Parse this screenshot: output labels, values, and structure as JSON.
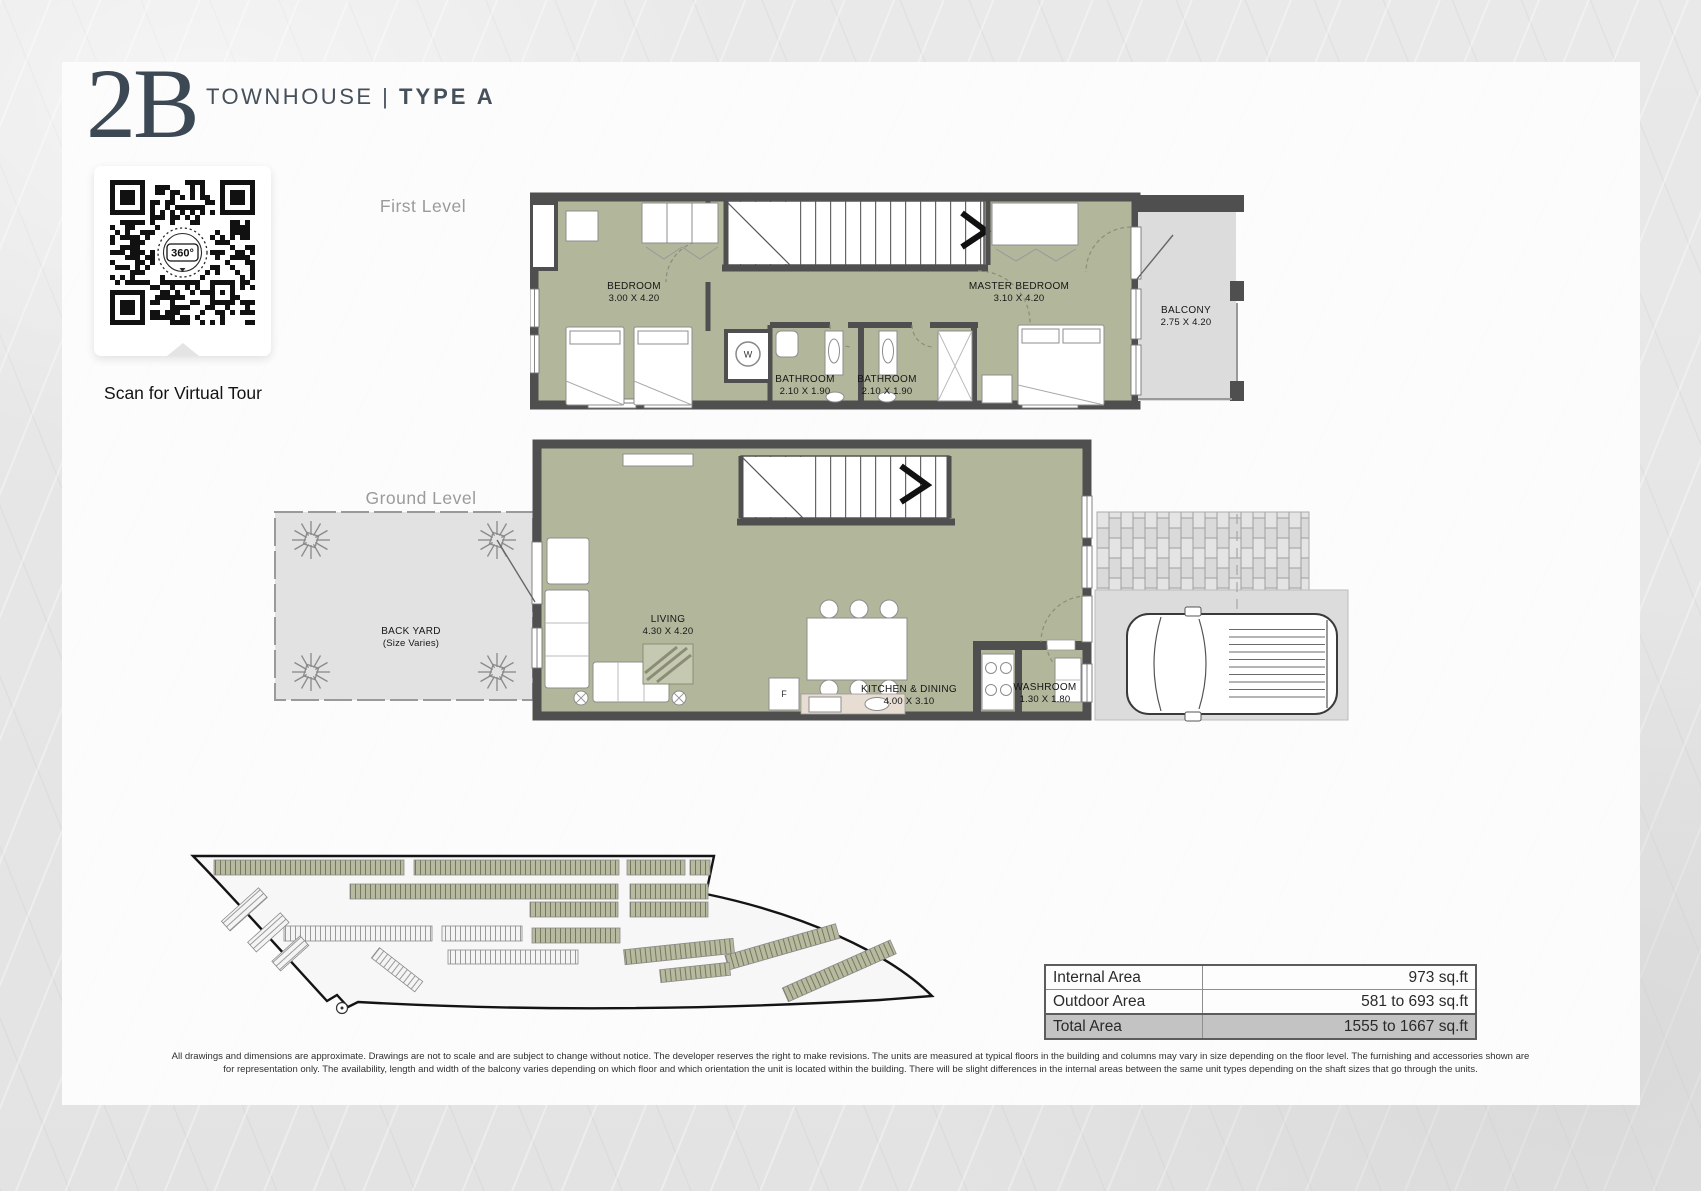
{
  "header": {
    "unit_code": "2B",
    "series": "TOWNHOUSE",
    "divider": "|",
    "type": "TYPE A"
  },
  "qr": {
    "badge": "360°",
    "caption": "Scan for Virtual Tour"
  },
  "levels": {
    "first": {
      "label": "First Level",
      "rooms": {
        "bedroom": {
          "name": "BEDROOM",
          "dims": "3.00 X 4.20"
        },
        "bath1": {
          "name": "BATHROOM",
          "dims": "2.10 X 1.90"
        },
        "bath2": {
          "name": "BATHROOM",
          "dims": "2.10 X 1.90"
        },
        "master": {
          "name": "MASTER BEDROOM",
          "dims": "3.10 X 4.20"
        },
        "balcony": {
          "name": "BALCONY",
          "dims": "2.75 X 4.20"
        }
      }
    },
    "ground": {
      "label": "Ground Level",
      "rooms": {
        "backyard": {
          "name": "BACK YARD",
          "dims": "(Size Varies)"
        },
        "living": {
          "name": "LIVING",
          "dims": "4.30 X 4.20"
        },
        "kitchen": {
          "name": "KITCHEN & DINING",
          "dims": "4.00 X 3.10"
        },
        "washroom": {
          "name": "WASHROOM",
          "dims": "1.30 X 1.80"
        }
      }
    },
    "glyphs": {
      "washer": "W",
      "fridge": "F"
    }
  },
  "area_table": {
    "rows": [
      {
        "label": "Internal Area",
        "value": "973 sq.ft"
      },
      {
        "label": "Outdoor Area",
        "value": "581 to 693 sq.ft"
      },
      {
        "label": "Total Area",
        "value": "1555 to 1667 sq.ft"
      }
    ]
  },
  "disclaimer": {
    "line1": "All drawings and dimensions are approximate. Drawings are not to scale and are subject to change without notice. The developer reserves the right to make revisions. The units are measured at typical floors in the building and columns may vary in size depending on the floor level. The furnishing and accessories shown are",
    "line2": "for representation only. The availability, length and width of the balcony varies depending on which floor and which orientation the unit is located within the building. There will be slight differences in the internal areas between the same unit types depending on the shaft sizes that go through the units."
  },
  "colors": {
    "accent": "#3c4854",
    "room_fill": "#b2b69b",
    "wall": "#4f4f4f",
    "paving": "#dcdcdc"
  }
}
